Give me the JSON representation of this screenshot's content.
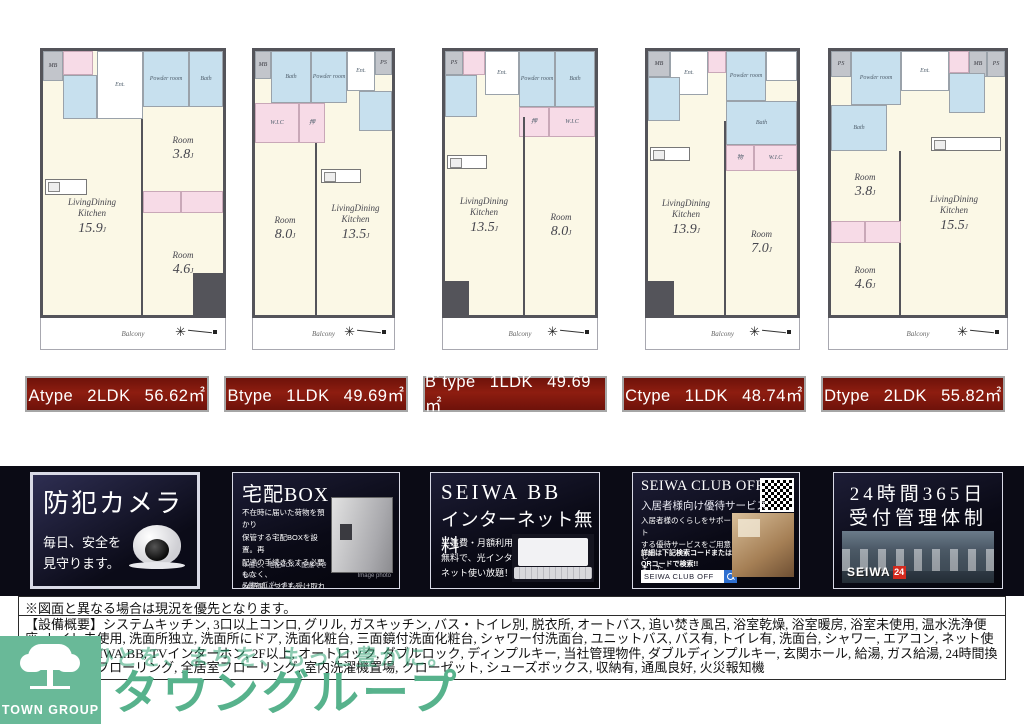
{
  "plan_common": {
    "room": "Room",
    "ldk_line1": "LivingDining",
    "ldk_line2": "Kitchen",
    "size_suffix": "J",
    "balcony": "Balcony",
    "bath": "Bath",
    "powder_room": "Powder room",
    "wc": "WC",
    "ent": "Ent.",
    "mb": "MB",
    "ps": "PS",
    "wic": "W.I.C",
    "closet": "押",
    "storage": "物"
  },
  "plans": [
    {
      "type_label": "Atype 2LDK 56.62㎡",
      "ldk_size": "15.9",
      "room1_size": "3.8",
      "room2_size": "4.6"
    },
    {
      "type_label": "Btype 1LDK 49.69㎡",
      "ldk_size": "13.5",
      "room1_size": "8.0"
    },
    {
      "type_label": "B´type 1LDK 49.69㎡",
      "ldk_size": "13.5",
      "room1_size": "8.0"
    },
    {
      "type_label": "Ctype 1LDK 48.74㎡",
      "ldk_size": "13.9",
      "room1_size": "7.0"
    },
    {
      "type_label": "Dtype 2LDK 55.82㎡",
      "ldk_size": "15.5",
      "room1_size": "3.8",
      "room2_size": "4.6"
    }
  ],
  "features": {
    "security": {
      "title": "防犯カメラ",
      "subtitle": "毎日、安全を\n見守ります。"
    },
    "delivery": {
      "title": "宅配BOX",
      "body": "不在時に届いた荷物を預かり\n保管する宅配BOXを設置。再\n配達の手続きをする必要もなく、\n24時間いつでも受け取れます。",
      "note": "※但し、宅配BOXへ配達できない\n品物もございます。",
      "caption": "Image photo"
    },
    "internet": {
      "title_line1": "SEIWA BB",
      "title_line2": "インターネット無料",
      "body": "工事費・月額利用料\n無料で、光インター\nネット使い放題！"
    },
    "cluboff": {
      "title": "SEIWA CLUB OFF",
      "subtitle": "入居者様向け優待サービス",
      "body": "入居者様のくらしをサポート\nする優待サービスをご用意し\nました。",
      "note": "詳細は下記検索コードまたは\nQRコードで検索!!",
      "search_label": "SEIWA CLUB OFF"
    },
    "management": {
      "title_line1": "24時間365日",
      "title_line2": "受付管理体制",
      "brand": "SEIWA",
      "brand_num": "24"
    }
  },
  "footer": {
    "disclaimer": "※図面と異なる場合は現況を優先となります。",
    "equipment": "【設備概要】システムキッチン, 3口以上コンロ, グリル, ガスキッチン, バス・トイレ別, 脱衣所, オートバス, 追い焚き風呂, 浴室乾燥, 浴室暖房, 浴室未使用, 温水洗浄便座, トイレ未使用, 洗面所独立, 洗面所にドア, 洗面化粧台, 三面鏡付洗面化粧台, シャワー付洗面台, ユニットバス, バス有, トイレ有, 洗面台, シャワー, エアコン, ネット使用料不要, SEIWA.BB, TVインターホン, 2F以上, オートロック, ダブルロック, ディンプルキー, 当社管理物件, ダブルディンプルキー, 玄関ホール, 給湯, ガス給湯, 24時間換気システム, フローリング, 全居室フローリング, 室内洗濯機置場, クローゼット, シューズボックス, 収納有, 通風良好, 火災報知機"
  },
  "logo": {
    "name": "TOWN GROUP",
    "katakana": "タウングループ",
    "slogan": "ひとを、まちを、もっと豊かに。"
  },
  "icons": {
    "compass_star": "✳"
  },
  "colors": {
    "label_bg": "#8E1D10",
    "band_bg": "#0B0B15",
    "logo_green": "#69B998",
    "plan_cream": "#FBF8E6",
    "plan_blue": "#C7E0EE",
    "plan_pink": "#F7DBE7"
  }
}
